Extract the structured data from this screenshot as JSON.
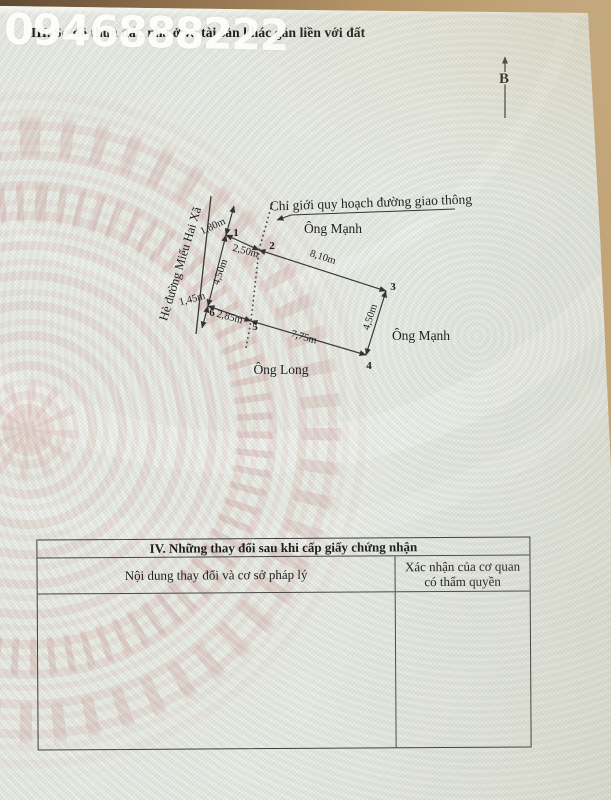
{
  "watermark_phone": "0946888222",
  "header": {
    "section_title": "III. Sơ đồ thửa đất, nhà ở và tài sản khác gắn liền với đất"
  },
  "compass": {
    "north_label": "B"
  },
  "diagram": {
    "planning_note": "Chỉ giới quy hoạch đường giao thông",
    "street": "Hè đường Miếu Hai Xã",
    "neighbor_top": "Ông Mạnh",
    "neighbor_right": "Ông Mạnh",
    "neighbor_bottom": "Ông Long",
    "points": {
      "p1": "1",
      "p2": "2",
      "p3": "3",
      "p4": "4",
      "p5": "5",
      "p6": "6"
    },
    "dims": {
      "frontage_ext_top": "1,80m",
      "edge_1_2": "2,50m",
      "edge_2_3": "8,10m",
      "edge_3_4": "4,50m",
      "edge_4_5": "7,75m",
      "edge_5_6": "2,85m",
      "edge_6_1": "4,50m",
      "frontage_ext_bottom": "1,45m"
    }
  },
  "table": {
    "title": "IV. Những thay đổi sau khi cấp giấy chứng nhận",
    "col1_header": "Nội dung thay đổi và cơ sở pháp lý",
    "col2_header": "Xác nhận của cơ quan có thẩm quyền"
  },
  "colors": {
    "paper": "#e8eae3",
    "ink": "#1f1f1f",
    "drum_pink": "#d8a7a2",
    "wood": "#a8865c",
    "watermark_text": "#ffffff"
  }
}
